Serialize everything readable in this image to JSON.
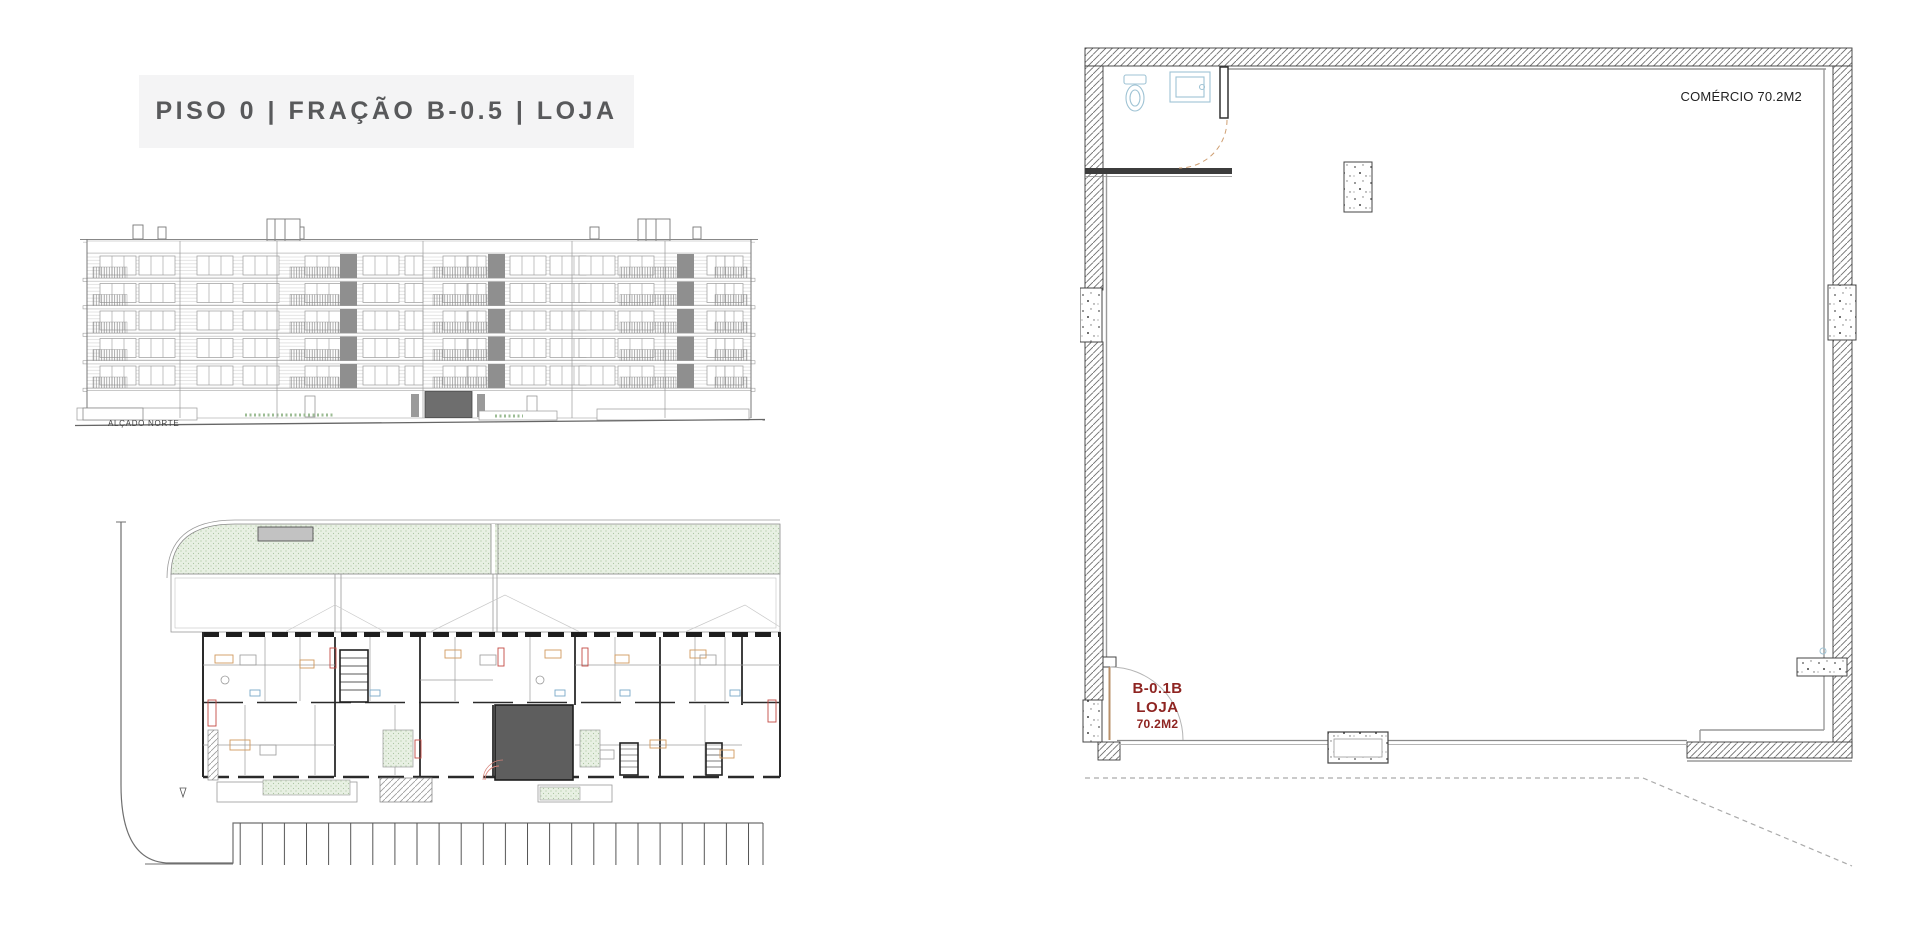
{
  "title": {
    "text": "PISO 0 | FRAÇÃO B-0.5 | LOJA"
  },
  "elevation": {
    "caption": "ALÇADO NORTE"
  },
  "unit_plan": {
    "area_label": "COMÉRCIO 70.2M2",
    "unit_code": "B-0.1B",
    "unit_type": "LOJA",
    "unit_area": "70.2M2"
  },
  "colors": {
    "title_grey": "#58595b",
    "accent_red": "#8e2421",
    "highlight_unit_grey": "#5e5e5e",
    "garden_green": "#e8f0e3",
    "title_bg": "#f4f4f5"
  }
}
